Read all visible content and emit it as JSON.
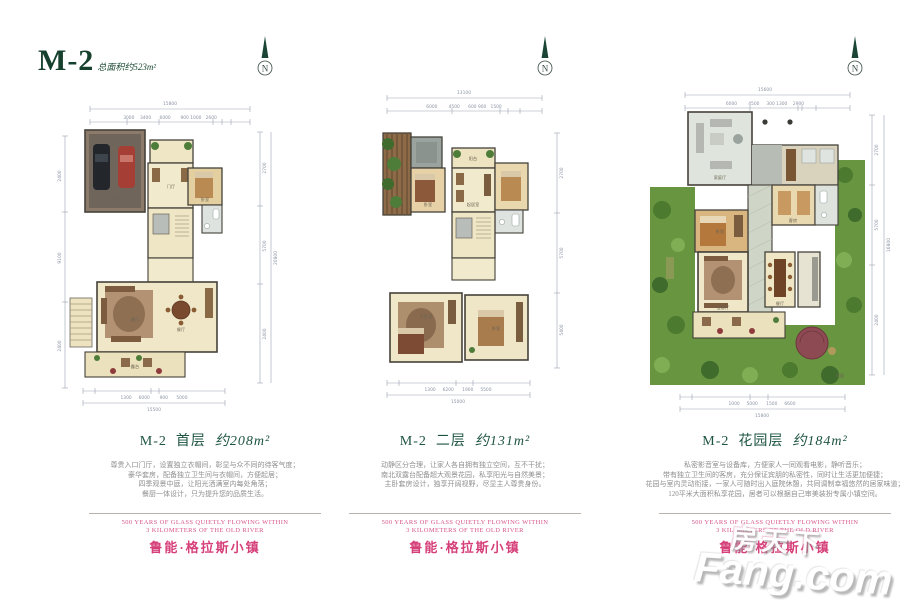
{
  "header": {
    "title": "M-2",
    "subtitle": "总面积约523m²"
  },
  "compass": {
    "label": "N"
  },
  "brand": {
    "tagline_line1": "500 YEARS OF GLASS QUIETLY FLOWING WITHIN",
    "tagline_line2": "3 KILOMETERS OF THE OLD RIVER",
    "name": "鲁能·格拉斯小镇"
  },
  "watermark": {
    "cn": "房天下",
    "en": "Fang.com"
  },
  "plans": [
    {
      "caption": {
        "code": "M-2",
        "floor": "首层",
        "area": "约208m²"
      },
      "description": [
        "尊贵入口门厅，设置独立衣帽间，彰显与众不同的待客气度；",
        "豪华套房，配备独立卫生间与衣帽间，方便起居；",
        "四季观景中庭，让阳光洒满室内每处角落；",
        "餐厨一体设计，只为提升您的品质生活。"
      ],
      "rooms": [
        "车库",
        "门厅",
        "卧室",
        "客厅",
        "餐厅",
        "露台"
      ],
      "dims": {
        "top_total": "15800",
        "top": "3000    3400      6000       900 1000   2600",
        "bottom": "1300     6000       900      5000",
        "bottom_total": "15500",
        "right": [
          "2700",
          "5700",
          "2400"
        ],
        "right_total": "20800",
        "left": [
          "2400",
          "9100",
          "2400"
        ]
      }
    },
    {
      "caption": {
        "code": "M-2",
        "floor": "二层",
        "area": "约131m²"
      },
      "description": [
        "动静区分合理，让家人各自拥有独立空间，互不干扰；",
        "南北双露台配备超大观景花园，私享阳光与自然美景；",
        "主卧套房设计，独享开阔视野，尽显主人尊贵身份。"
      ],
      "rooms": [
        "阳台",
        "卧室",
        "起居室",
        "主卧室",
        "卧室"
      ],
      "dims": {
        "top_total": "13100",
        "top": "6000        4500      600 900   1500",
        "bottom": "1300     6200      1900     5500",
        "bottom_total": "15000",
        "right": [
          "2700",
          "5700",
          "5400"
        ],
        "right_total": "",
        "left": []
      }
    },
    {
      "caption": {
        "code": "M-2",
        "floor": "花园层",
        "area": "约184m²"
      },
      "description": [
        "私密影音室与设备库，方便家人一同观看电影，静听音乐；",
        "带有独立卫生间的客房，充分保证宾朋的私密性，同时让生活更加便捷；",
        "花园与室内灵动衔接，一家人可随时出入庭院休憩，共同调制幸福悠然的居家味道；",
        "120平米大面积私享花园，居者可以根据自己审美装扮专属小镇空间。"
      ],
      "rooms": [
        "家庭厅",
        "客房",
        "卧室",
        "会客厅",
        "餐厅",
        "花园"
      ],
      "dims": {
        "top_total": "15600",
        "top": "6000        4500     300 1300    2900",
        "bottom": "1000     5000      1500     6600",
        "bottom_total": "15800",
        "right": [
          "2700",
          "5700",
          "2400"
        ],
        "right_total": "16800",
        "left": []
      }
    }
  ]
}
